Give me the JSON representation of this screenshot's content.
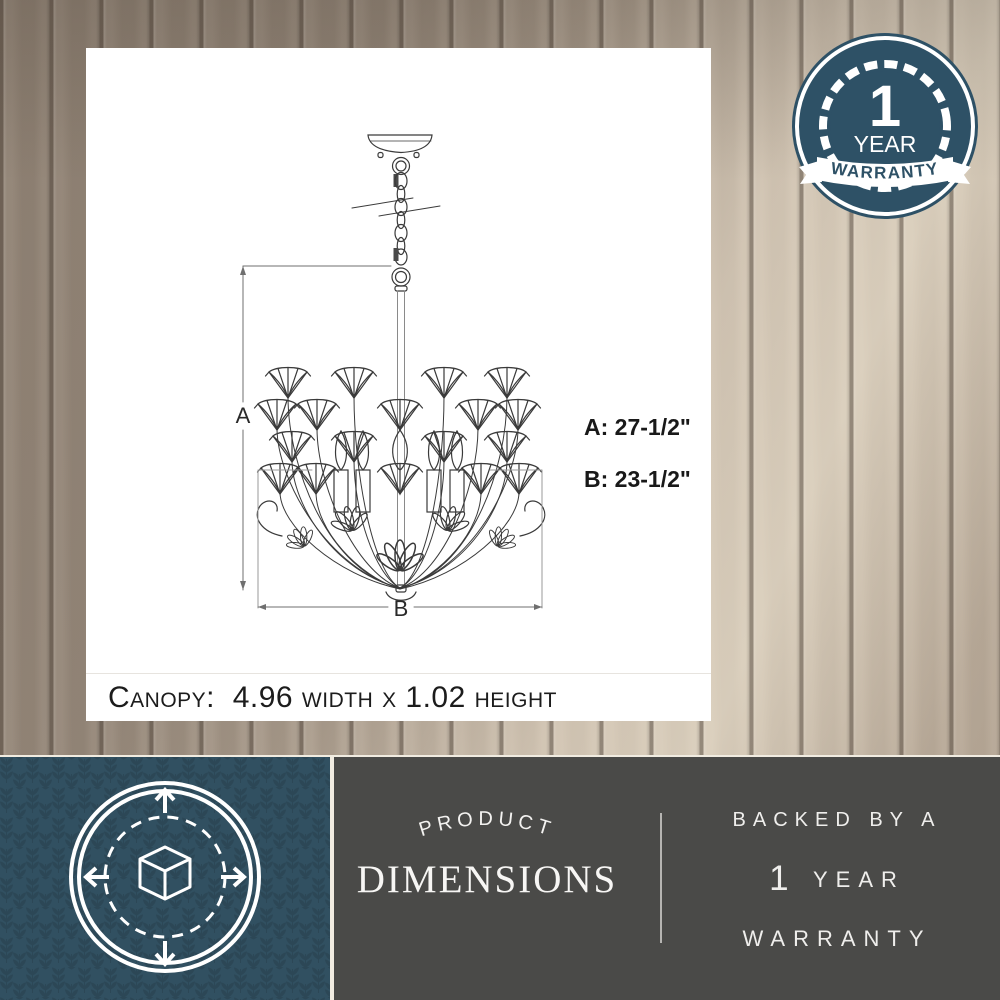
{
  "warranty_badge": {
    "number": "1",
    "year_label": "YEAR",
    "warranty_label": "WARRANTY"
  },
  "diagram": {
    "dim_letter_a": "A",
    "dim_letter_b": "B",
    "dim_a_text": "A: 27-1/2\"",
    "dim_b_text": "B: 23-1/2\"",
    "canopy_text": "Canopy:  4.96 width x 1.02 height"
  },
  "footer": {
    "arc_label": "PRODUCT",
    "title": "DIMENSIONS",
    "backed_line": "BACKED BY A",
    "year_number": "1",
    "year_word": "YEAR",
    "warranty_word": "WARRANTY"
  },
  "icons": {
    "warranty_badge_icon": "1-year-warranty-seal",
    "dimension_icon": "cube-with-expand-arrows"
  },
  "colors": {
    "badge_teal": "#2e5166",
    "tile_teal": "#315061",
    "panel_gray": "#4a4a48",
    "band_light": "#f1ece1",
    "line_dark": "#3a3a3a"
  }
}
